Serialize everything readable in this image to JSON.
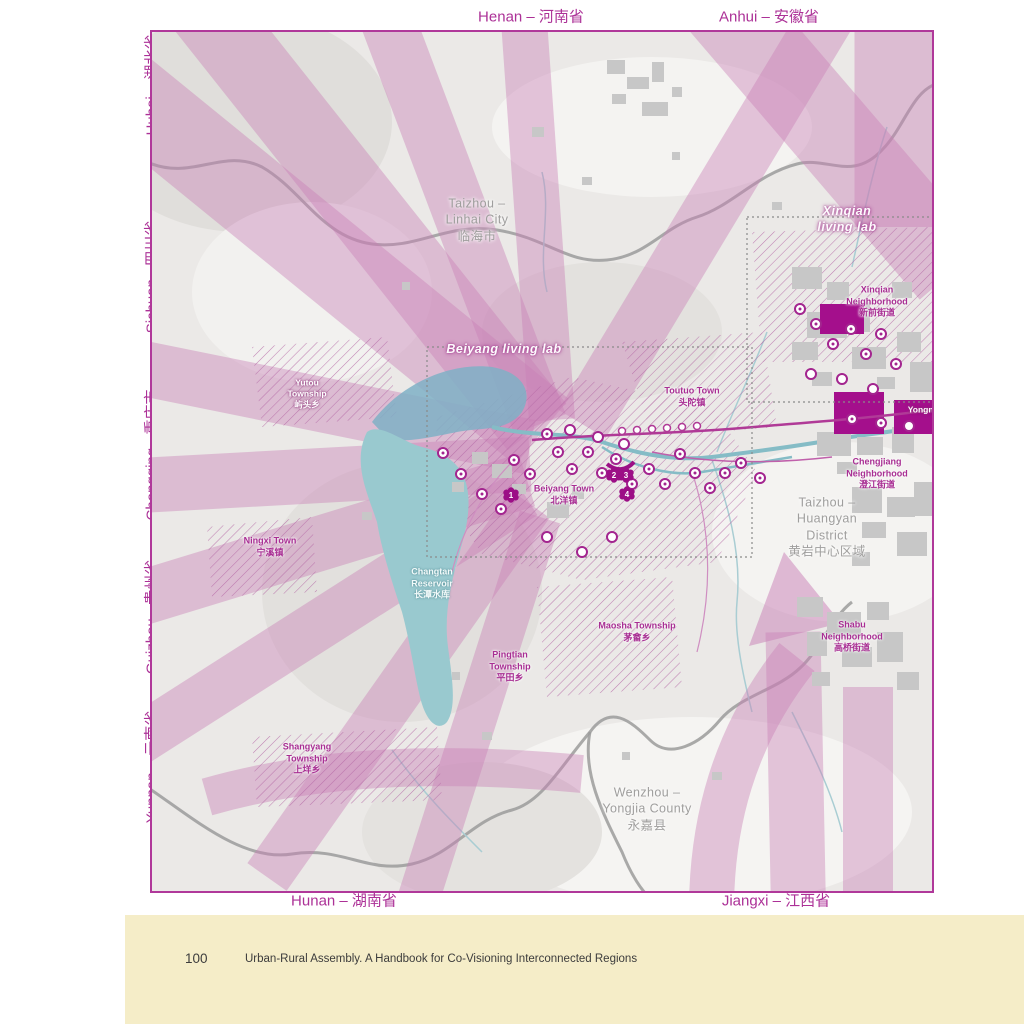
{
  "footer": {
    "page_number": "100",
    "book_title": "Urban-Rural Assembly. A Handbook for Co-Visioning Interconnected Regions"
  },
  "map": {
    "colors": {
      "frame": "#b0389a",
      "flow_arrow_pink": "#c87eb6",
      "deep_magenta": "#a40f8c",
      "reservoir_teal": "#99c9cf",
      "label_purple": "#a82e93",
      "label_gray": "#9f9e9d",
      "footer_cream": "#f5edc8"
    },
    "edge_labels": {
      "henan": "Henan – 河南省",
      "anhui": "Anhui – 安徽省",
      "hubei": "Hubei – 湖北省",
      "sichuan": "Sichuan - 四川省",
      "chongqing": "Chongqing - 重庆市",
      "guizhou": "Guizhou - 贵州省",
      "yunnan": "Yunnan – 云南省",
      "hunan": "Hunan – 湖南省",
      "jiangxi": "Jiangxi – 江西省"
    },
    "living_labs": {
      "xinqian": "Xinqian living lab",
      "beiyang": "Beiyang living lab"
    },
    "places": {
      "taizhou_linhai": "Taizhou –\nLinhai City\n临海市",
      "yutou": "Yutou\nTownship\n屿头乡",
      "toutuo": "Toutuo Town\n头陀镇",
      "xinqian_neighborhood": "Xinqian\nNeighborhood\n新前街道",
      "chengjiang_neighborhood": "Chengjiang\nNeighborhood\n澄江街道",
      "taizhou_huangyan": "Taizhou –\nHuangyan District\n黄岩中心区域",
      "ningxi": "Ningxi Town\n宁溪镇",
      "changtan_reservoir": "Changtan\nReservoir\n长潭水库",
      "beiyang_town": "Beiyang Town\n北洋镇",
      "maosha": "Maosha Township\n茅畲乡",
      "pingtian": "Pingtian\nTownship\n平田乡",
      "shangyang": "Shangyang\nTownship\n上垟乡",
      "wenzhou_yongjia": "Wenzhou –\nYongjia County\n永嘉县",
      "shabu": "Shabu\nNeighborhood\n高桥街道",
      "yongning": "Yongning"
    },
    "markers": {
      "numbered": [
        "1",
        "2",
        "3",
        "4"
      ]
    }
  }
}
